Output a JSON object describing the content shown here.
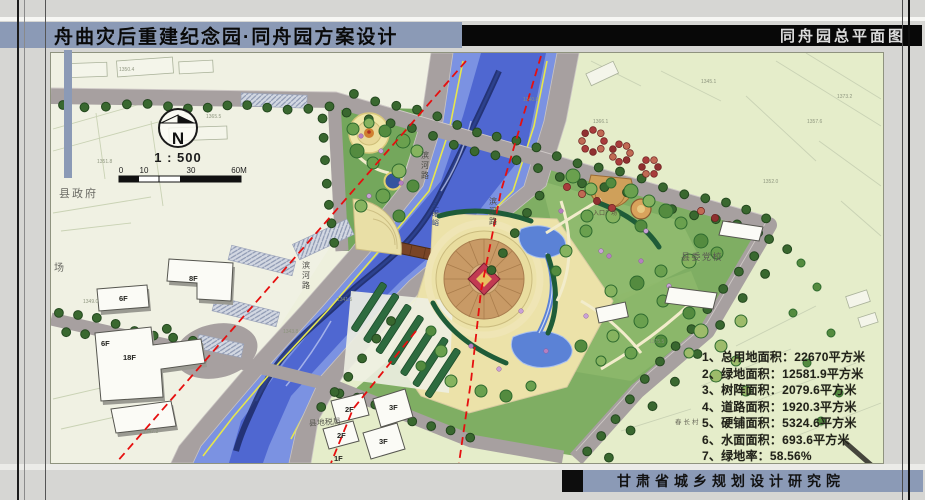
{
  "header": {
    "title": "舟曲灾后重建纪念园·同舟园方案设计",
    "plan_name": "同舟园总平面图"
  },
  "footer": {
    "institute": "甘肃省城乡规划设计研究院"
  },
  "map": {
    "compass_label": "N",
    "scale_text": "1 : 500",
    "scale_ticks": [
      "0",
      "10",
      "30",
      "60M"
    ],
    "stats": [
      "1、总用地面积：22670平方米",
      "2、绿地面积：12581.9平方米",
      "3、树阵面积：2079.6平方米",
      "4、道路面积：1920.3平方米",
      "5、硬铺面积：5324.6平方米",
      "6、水面面积：693.6平方米",
      "7、绿地率：58.56%"
    ],
    "labels": {
      "county_government": "县政府",
      "square": "场",
      "party_school": "县委党校",
      "tax_bureau": "县地税局",
      "village": "春长村",
      "entrance_plaza": "入口广场",
      "river_name": "三眼峪",
      "riverside_road_w1": "滨河路",
      "riverside_road_w2": "滨河路",
      "riverside_road_e": "滨河路"
    },
    "building_labels": [
      "8F",
      "6F",
      "6F",
      "18F",
      "2F",
      "3F",
      "2F",
      "3F",
      "1F"
    ],
    "elevations": [
      "1350.4",
      "1365.5",
      "1351.8",
      "1345.1",
      "1357.6",
      "1373.2",
      "1352.0",
      "1341.5",
      "1343.8",
      "1375.5",
      "1343.5",
      "1349.0",
      "1347.2",
      "1340.8",
      "1366.1"
    ]
  },
  "colors": {
    "band_blue": "#8b9ab6",
    "band_black": "#0a0a0a",
    "river_blue": "#4a63cf",
    "boundary_red": "#e60f0f"
  }
}
